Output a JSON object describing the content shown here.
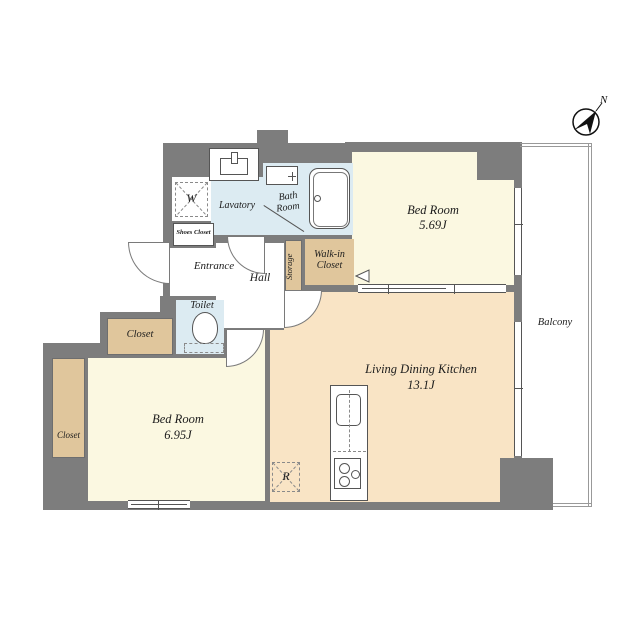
{
  "colors": {
    "wall": "#7d7d7d",
    "cream": "#fbf8e1",
    "peach": "#f9e4c5",
    "tan": "#e0c69c",
    "blue": "#dcebf2",
    "line": "#555555",
    "bline": "#999999"
  },
  "labels": {
    "compass_north": "N",
    "balcony": "Balcony",
    "bedroom_top": {
      "name": "Bed Room",
      "size": "5.69J"
    },
    "bedroom_bottom": {
      "name": "Bed Room",
      "size": "6.95J"
    },
    "ldk": {
      "name": "Living Dining Kitchen",
      "size": "13.1J"
    },
    "entrance": "Entrance",
    "hall": "Hall",
    "toilet": "Toilet",
    "lavatory": "Lavatory",
    "bathroom": {
      "line1": "Bath",
      "line2": "Room"
    },
    "walk_in_closet": {
      "line1": "Walk-in",
      "line2": "Closet"
    },
    "storage": "Storage",
    "shoes_closet": "Shoes Closet",
    "closet_upper": "Closet",
    "closet_left": "Closet",
    "washing_machine": "W",
    "refrigerator": "R"
  }
}
